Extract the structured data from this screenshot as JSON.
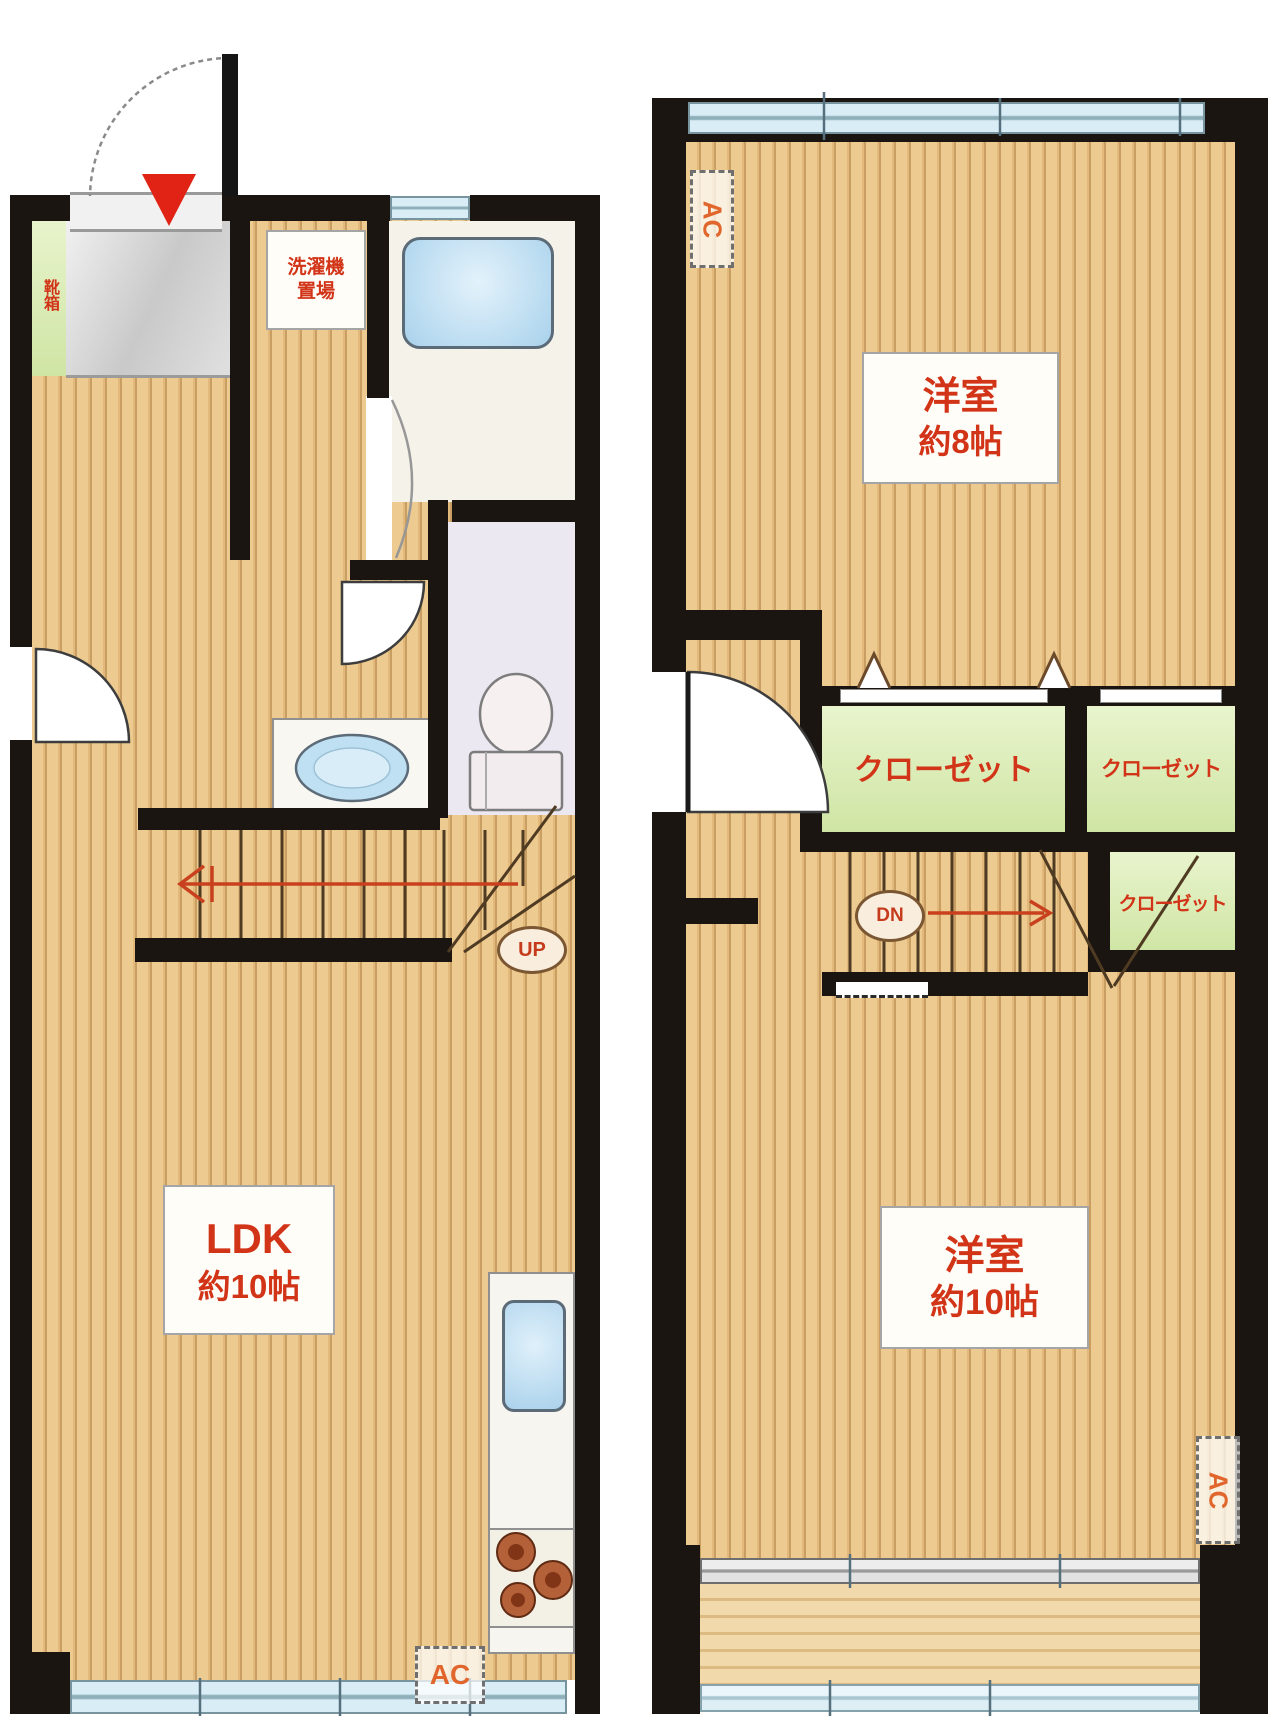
{
  "title": "2-story apartment floor plan",
  "colors": {
    "wall": "#1a1511",
    "wood": "#edca90",
    "wood_stripe": "#c99e63",
    "closet_green": "#d9ecae",
    "shoe_green": "#dcedc3",
    "label_red": "#d23418",
    "ac_orange": "#e0662c",
    "water_blue": "#abd2ec",
    "window_blue": "#d9edf6",
    "entrance_tile": "#d9d9d9",
    "toilet_floor": "#ebe8f1",
    "balcony_wood": "#ecd2a2",
    "entry_marker_red": "#e02315"
  },
  "floor1": {
    "shoe_cabinet": "靴箱",
    "laundry_line1": "洗濯機",
    "laundry_line2": "置場",
    "ldk_name": "LDK",
    "ldk_size": "約10帖",
    "stairs_up": "UP",
    "ac": "AC"
  },
  "floor2": {
    "ac_top": "AC",
    "room8_name": "洋室",
    "room8_size": "約8帖",
    "closet_left": "クローゼット",
    "closet_right": "クローゼット",
    "closet_lower": "クローゼット",
    "stairs_down": "DN",
    "room10_name": "洋室",
    "room10_size": "約10帖",
    "ac_right": "AC"
  }
}
